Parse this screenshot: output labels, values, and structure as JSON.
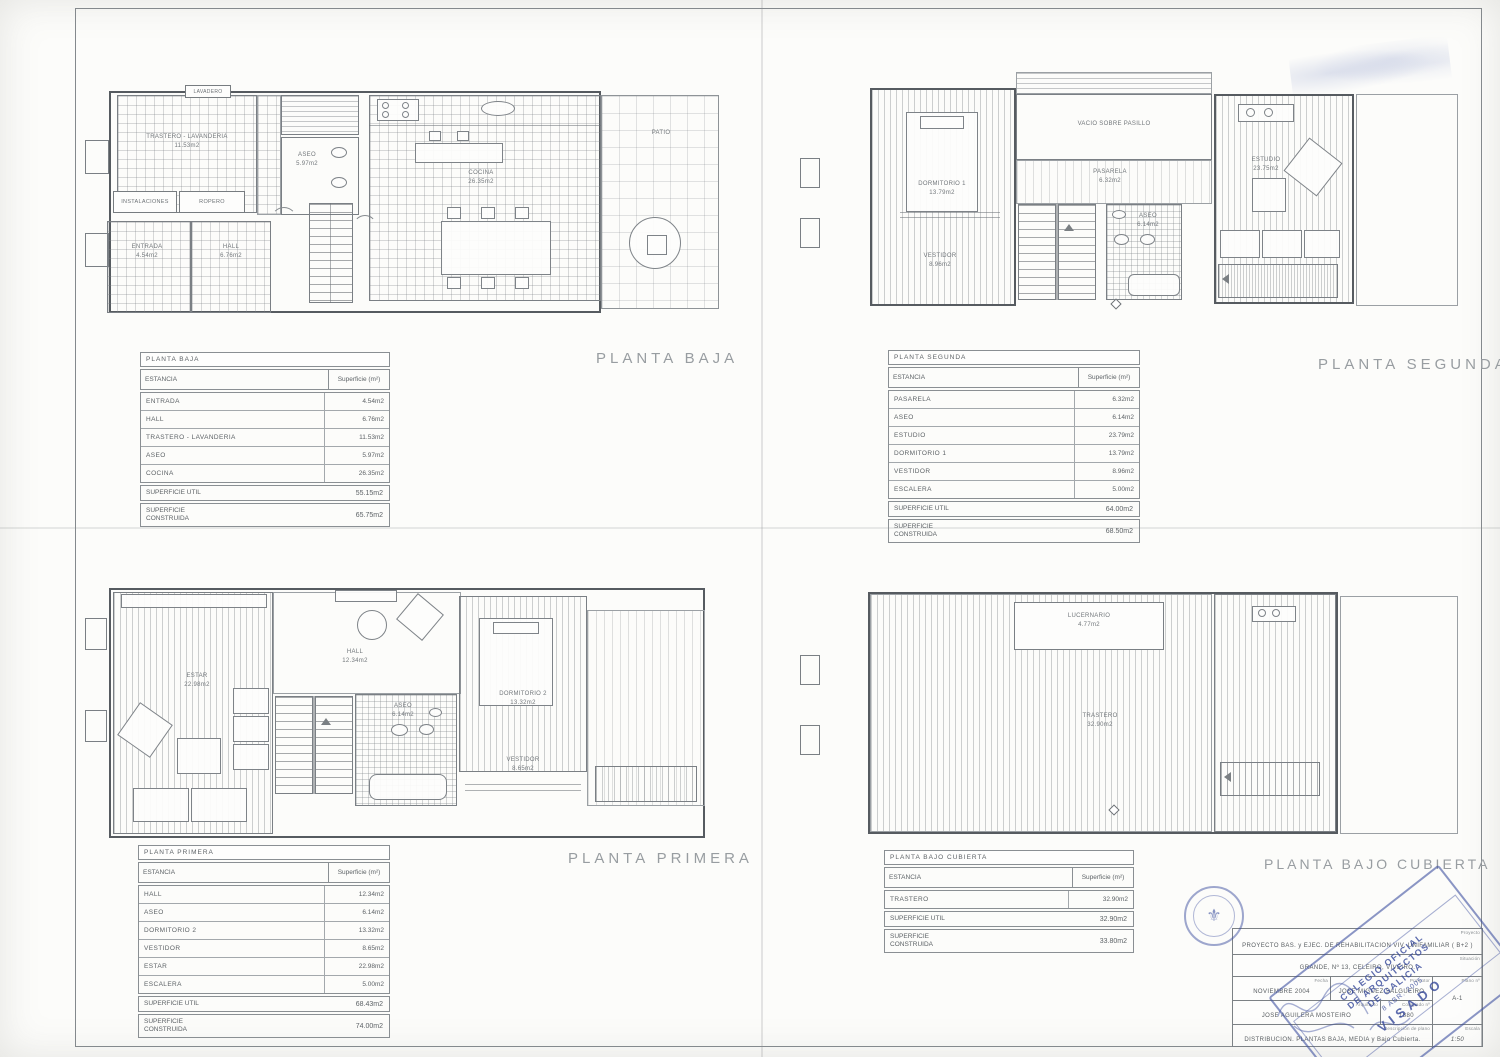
{
  "titles": {
    "baja": "PLANTA BAJA",
    "segunda": "PLANTA SEGUNDA",
    "primera": "PLANTA PRIMERA",
    "bajo": "PLANTA BAJO CUBIERTA"
  },
  "tables": {
    "baja": {
      "title": "PLANTA BAJA",
      "estancia": "ESTANCIA",
      "superficie": "Superficie (m²)",
      "rows": [
        {
          "name": "ENTRADA",
          "area": "4.54m2"
        },
        {
          "name": "HALL",
          "area": "6.76m2"
        },
        {
          "name": "TRASTERO - LAVANDERIA",
          "area": "11.53m2"
        },
        {
          "name": "ASEO",
          "area": "5.97m2"
        },
        {
          "name": "COCINA",
          "area": "26.35m2"
        }
      ],
      "util_label": "SUPERFICIE UTIL",
      "util": "55.15m2",
      "cons_label": "SUPERFICIE CONSTRUIDA",
      "cons": "65.75m2"
    },
    "segunda": {
      "title": "PLANTA SEGUNDA",
      "estancia": "ESTANCIA",
      "superficie": "Superficie (m²)",
      "rows": [
        {
          "name": "PASARELA",
          "area": "6.32m2"
        },
        {
          "name": "ASEO",
          "area": "6.14m2"
        },
        {
          "name": "ESTUDIO",
          "area": "23.79m2"
        },
        {
          "name": "DORMITORIO 1",
          "area": "13.79m2"
        },
        {
          "name": "VESTIDOR",
          "area": "8.96m2"
        },
        {
          "name": "ESCALERA",
          "area": "5.00m2"
        }
      ],
      "util_label": "SUPERFICIE UTIL",
      "util": "64.00m2",
      "cons_label": "SUPERFICIE CONSTRUIDA",
      "cons": "68.50m2"
    },
    "primera": {
      "title": "PLANTA PRIMERA",
      "estancia": "ESTANCIA",
      "superficie": "Superficie (m²)",
      "rows": [
        {
          "name": "HALL",
          "area": "12.34m2"
        },
        {
          "name": "ASEO",
          "area": "6.14m2"
        },
        {
          "name": "DORMITORIO 2",
          "area": "13.32m2"
        },
        {
          "name": "VESTIDOR",
          "area": "8.65m2"
        },
        {
          "name": "ESTAR",
          "area": "22.98m2"
        },
        {
          "name": "ESCALERA",
          "area": "5.00m2"
        }
      ],
      "util_label": "SUPERFICIE UTIL",
      "util": "68.43m2",
      "cons_label": "SUPERFICIE CONSTRUIDA",
      "cons": "74.00m2"
    },
    "bajo": {
      "title": "PLANTA BAJO CUBIERTA",
      "estancia": "ESTANCIA",
      "superficie": "Superficie (m²)",
      "rows": [
        {
          "name": "TRASTERO",
          "area": "32.90m2"
        }
      ],
      "util_label": "SUPERFICIE UTIL",
      "util": "32.90m2",
      "cons_label": "SUPERFICIE CONSTRUIDA",
      "cons": "33.80m2"
    }
  },
  "plans": {
    "baja": {
      "labels": {
        "lavadero": "LAVADERO",
        "trastero": "TRASTERO - LAVANDERIA",
        "trastero_a": "11.53m2",
        "instalaciones": "INSTALACIONES",
        "ropero": "ROPERO",
        "entrada": "ENTRADA",
        "entrada_a": "4.54m2",
        "hall": "HALL",
        "hall_a": "6.76m2",
        "aseo": "ASEO",
        "aseo_a": "5.97m2",
        "cocina": "COCINA",
        "cocina_a": "26.35m2",
        "patio": "PATIO"
      }
    },
    "segunda": {
      "labels": {
        "vacio": "VACIO SOBRE PASILLO",
        "dormitorio": "DORMITORIO 1",
        "dormitorio_a": "13.79m2",
        "vestidor": "VESTIDOR",
        "vestidor_a": "8.96m2",
        "pasarela": "PASARELA",
        "pasarela_a": "6.32m2",
        "aseo": "ASEO",
        "aseo_a": "6.14m2",
        "estudio": "ESTUDIO",
        "estudio_a": "23.75m2"
      }
    },
    "primera": {
      "labels": {
        "estar": "ESTAR",
        "estar_a": "22.98m2",
        "hall": "HALL",
        "hall_a": "12.34m2",
        "aseo": "ASEO",
        "aseo_a": "6.14m2",
        "dormitorio": "DORMITORIO 2",
        "dormitorio_a": "13.32m2",
        "vestidor": "VESTIDOR",
        "vestidor_a": "8.65m2"
      }
    },
    "bajo": {
      "labels": {
        "lucernario": "LUCERNARIO",
        "lucernario_a": "4.77m2",
        "trastero": "TRASTERO",
        "trastero_a": "32.90m2"
      }
    }
  },
  "titleblock": {
    "proyecto_label": "Proyecto",
    "proyecto": "PROYECTO BAS. y EJEC. DE REHABILITACION VIV. UNIFAMILIAR ( B+2 )",
    "situacion_label": "Situación",
    "situacion": "GRANDE, Nº 13, CELEIRO, VIVEIRO.",
    "fecha_label": "Fecha",
    "fecha": "NOVIEMBRE 2004",
    "promotor_label": "Promotor",
    "promotor": "JOSE MIGUEZ SALGUEIRO",
    "plano_label": "Plano nº",
    "plano": "A-1",
    "arquitecto_label": "Arquitecto",
    "arquitecto": "JOSE AGUILERA MOSTEIRO",
    "colegiado_label": "Colegiado nº",
    "colegiado": "1880",
    "descripcion_label": "Descripción de plano",
    "descripcion": "DISTRIBUCION. PLANTAS BAJA, MEDIA y Bajo Cubierta.",
    "escala_label": "Escala",
    "escala": "1:50"
  },
  "stamps": {
    "colegio_line1": "COLEGIO OFICIAL",
    "colegio_line2": "DE ARQUITECTOS",
    "colegio_line3": "DE GALICIA",
    "fecha_visado": "8 ABR. 2005",
    "visado": "VISADO"
  }
}
